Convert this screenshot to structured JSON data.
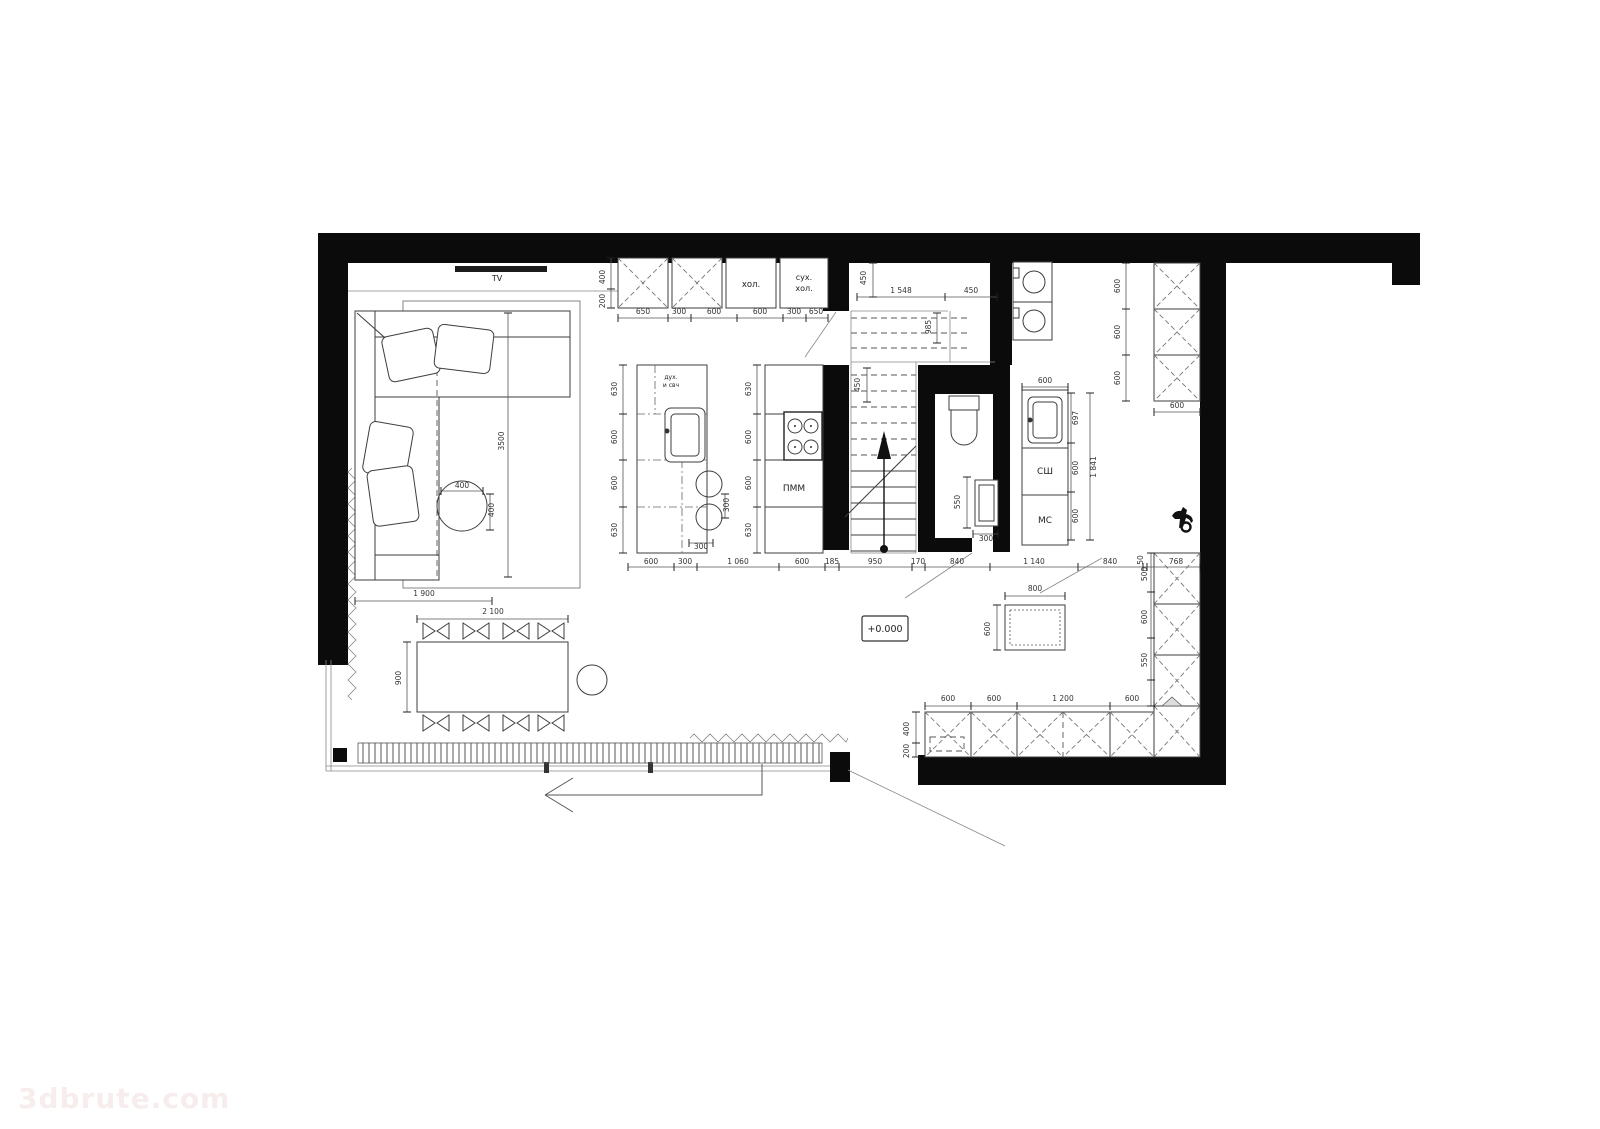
{
  "watermark": {
    "text": "3dbrute.com"
  },
  "colors": {
    "walls": "#0b0b0b",
    "lines": "#3d3d3d",
    "dims": "#333333",
    "watermark": "#f7eded"
  },
  "equipment_labels": {
    "tv": "TV",
    "fridge": "хол.",
    "dry_fridge_1": "сух.",
    "dry_fridge_2": "хол.",
    "oven_1": "дух.",
    "oven_2": "и свч",
    "dishwasher": "ПММ",
    "drying_cabinet": "СШ",
    "sink_cabinet": "МС",
    "elevation": "+0.000"
  },
  "dim_labels": [
    {
      "text": "400",
      "x": 605,
      "y": 277,
      "rot": -90
    },
    {
      "text": "200",
      "x": 605,
      "y": 301,
      "rot": -90
    },
    {
      "text": "650",
      "x": 643,
      "y": 314
    },
    {
      "text": "300",
      "x": 679,
      "y": 314,
      "size": 6.5
    },
    {
      "text": "600",
      "x": 714,
      "y": 314
    },
    {
      "text": "600",
      "x": 760,
      "y": 314
    },
    {
      "text": "300",
      "x": 794,
      "y": 314,
      "size": 6.5
    },
    {
      "text": "650",
      "x": 816,
      "y": 314
    },
    {
      "text": "450",
      "x": 866,
      "y": 278,
      "rot": -90
    },
    {
      "text": "1 548",
      "x": 901,
      "y": 293
    },
    {
      "text": "450",
      "x": 971,
      "y": 293
    },
    {
      "text": "985",
      "x": 931,
      "y": 327,
      "rot": -90
    },
    {
      "text": "450",
      "x": 860,
      "y": 385,
      "rot": -90
    },
    {
      "text": "630",
      "x": 617,
      "y": 389,
      "rot": -90
    },
    {
      "text": "600",
      "x": 617,
      "y": 437,
      "rot": -90
    },
    {
      "text": "600",
      "x": 617,
      "y": 483,
      "rot": -90
    },
    {
      "text": "630",
      "x": 617,
      "y": 530,
      "rot": -90
    },
    {
      "text": "630",
      "x": 751,
      "y": 389,
      "rot": -90
    },
    {
      "text": "600",
      "x": 751,
      "y": 437,
      "rot": -90
    },
    {
      "text": "600",
      "x": 751,
      "y": 483,
      "rot": -90
    },
    {
      "text": "630",
      "x": 751,
      "y": 530,
      "rot": -90
    },
    {
      "text": "300",
      "x": 729,
      "y": 505,
      "rot": -90,
      "size": 6.5
    },
    {
      "text": "300",
      "x": 701,
      "y": 549,
      "size": 6.5
    },
    {
      "text": "3500",
      "x": 504,
      "y": 441,
      "rot": -90
    },
    {
      "text": "400",
      "x": 462,
      "y": 488,
      "size": 6.5
    },
    {
      "text": "400",
      "x": 494,
      "y": 510,
      "rot": -90,
      "size": 6.5
    },
    {
      "text": "1 900",
      "x": 424,
      "y": 596
    },
    {
      "text": "2 100",
      "x": 493,
      "y": 614
    },
    {
      "text": "900",
      "x": 401,
      "y": 678,
      "rot": -90
    },
    {
      "text": "600",
      "x": 651,
      "y": 564
    },
    {
      "text": "300",
      "x": 685,
      "y": 564,
      "size": 6.5
    },
    {
      "text": "1 060",
      "x": 738,
      "y": 564
    },
    {
      "text": "600",
      "x": 802,
      "y": 564
    },
    {
      "text": "185",
      "x": 832,
      "y": 564,
      "size": 6
    },
    {
      "text": "950",
      "x": 875,
      "y": 564
    },
    {
      "text": "170",
      "x": 918,
      "y": 564,
      "size": 6
    },
    {
      "text": "840",
      "x": 957,
      "y": 564
    },
    {
      "text": "1 140",
      "x": 1034,
      "y": 564
    },
    {
      "text": "840",
      "x": 1110,
      "y": 564
    },
    {
      "text": "50",
      "x": 1143,
      "y": 560,
      "rot": -90,
      "size": 6
    },
    {
      "text": "768",
      "x": 1176,
      "y": 564
    },
    {
      "text": "550",
      "x": 960,
      "y": 502,
      "rot": -90
    },
    {
      "text": "300",
      "x": 986,
      "y": 541,
      "size": 6.5
    },
    {
      "text": "600",
      "x": 1045,
      "y": 383
    },
    {
      "text": "697",
      "x": 1078,
      "y": 418,
      "rot": -90,
      "size": 7
    },
    {
      "text": "600",
      "x": 1078,
      "y": 468,
      "rot": -90,
      "size": 7
    },
    {
      "text": "600",
      "x": 1078,
      "y": 516,
      "rot": -90,
      "size": 7
    },
    {
      "text": "1 841",
      "x": 1096,
      "y": 467,
      "rot": -90
    },
    {
      "text": "600",
      "x": 1120,
      "y": 286,
      "rot": -90
    },
    {
      "text": "600",
      "x": 1120,
      "y": 332,
      "rot": -90
    },
    {
      "text": "600",
      "x": 1120,
      "y": 378,
      "rot": -90
    },
    {
      "text": "600",
      "x": 1177,
      "y": 408
    },
    {
      "text": "500",
      "x": 1147,
      "y": 574,
      "rot": -90
    },
    {
      "text": "600",
      "x": 1147,
      "y": 617,
      "rot": -90
    },
    {
      "text": "550",
      "x": 1147,
      "y": 660,
      "rot": -90
    },
    {
      "text": "600",
      "x": 948,
      "y": 701
    },
    {
      "text": "600",
      "x": 994,
      "y": 701
    },
    {
      "text": "1 200",
      "x": 1063,
      "y": 701
    },
    {
      "text": "600",
      "x": 1132,
      "y": 701
    },
    {
      "text": "400",
      "x": 909,
      "y": 729,
      "rot": -90,
      "size": 6.5
    },
    {
      "text": "200",
      "x": 909,
      "y": 751,
      "rot": -90,
      "size": 6.5
    },
    {
      "text": "800",
      "x": 1035,
      "y": 591
    },
    {
      "text": "600",
      "x": 990,
      "y": 629,
      "rot": -90
    }
  ]
}
